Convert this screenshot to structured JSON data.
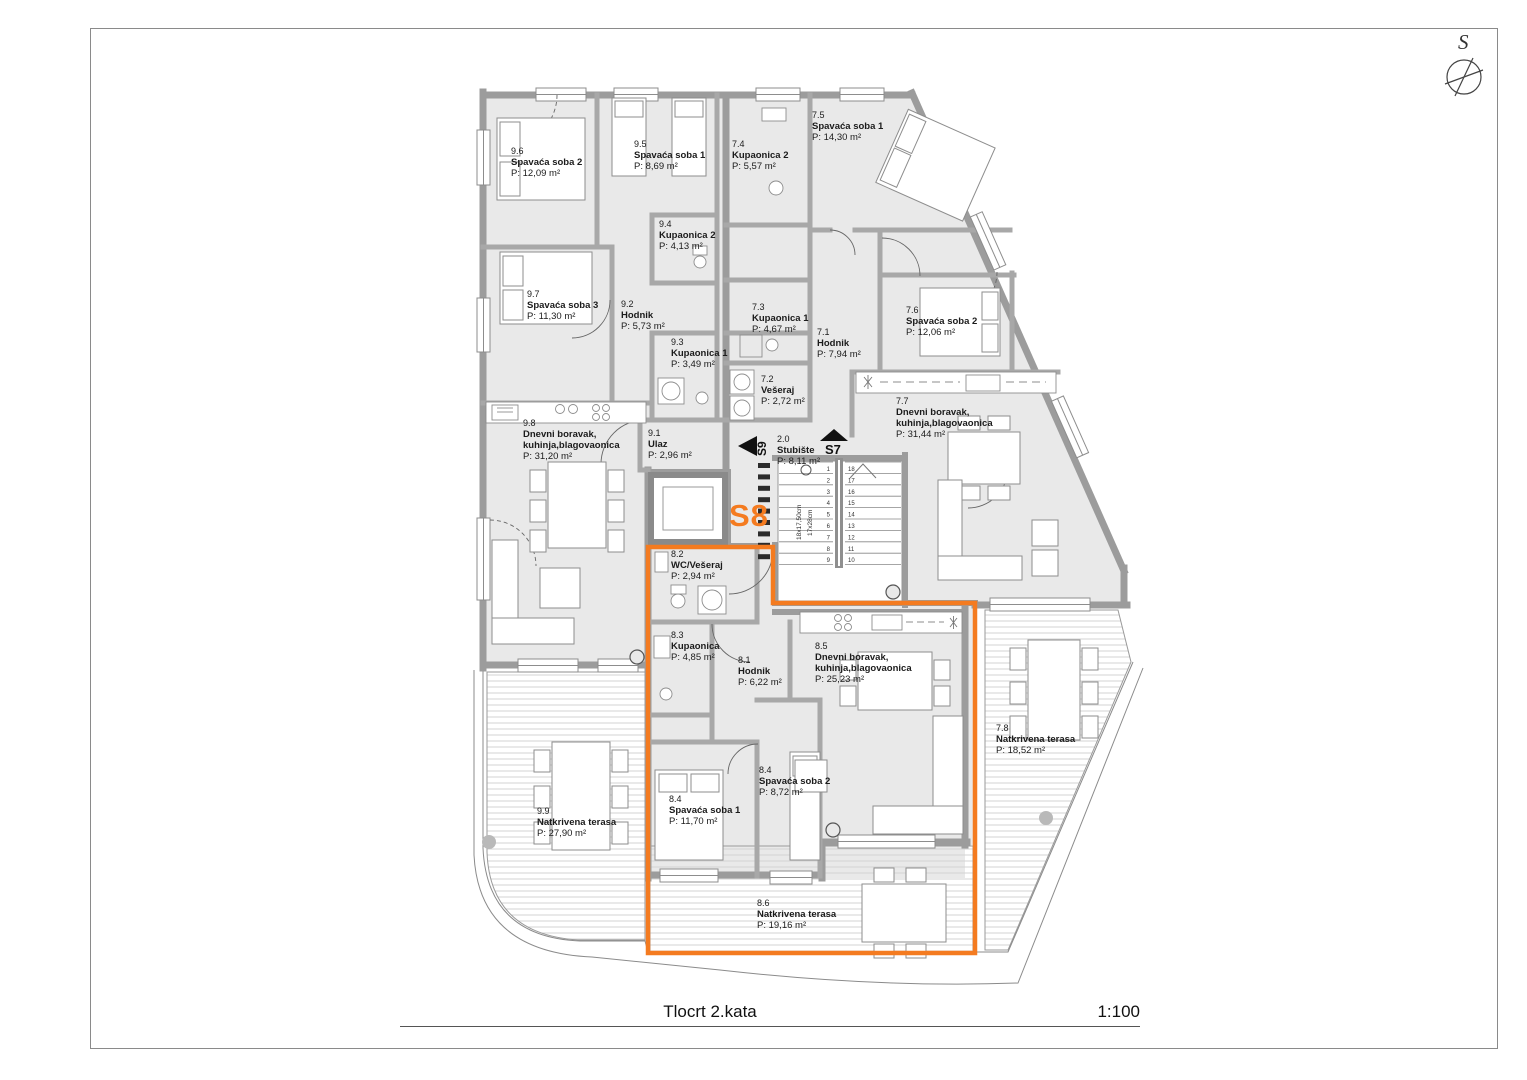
{
  "page": {
    "title": "Tlocrt 2.kata",
    "scale": "1:100",
    "north_label": "S"
  },
  "unit_highlight": {
    "label": "S8",
    "color": "#f47b20"
  },
  "arrows": {
    "s9": "S9",
    "s7": "S7"
  },
  "stairs": {
    "dim_risers": "18x17,50cm",
    "dim_treads": "17x28cm",
    "left_numbers": [
      1,
      2,
      3,
      4,
      5,
      6,
      7,
      8,
      9
    ],
    "right_numbers": [
      18,
      17,
      16,
      15,
      14,
      13,
      12,
      11,
      10
    ]
  },
  "rooms": [
    {
      "id": "9.6",
      "name": "Spavaća soba 2",
      "area": "P: 12,09 m²",
      "x": 511,
      "y": 146
    },
    {
      "id": "9.5",
      "name": "Spavaća soba 1",
      "area": "P: 8,69 m²",
      "x": 634,
      "y": 139
    },
    {
      "id": "9.4",
      "name": "Kupaonica 2",
      "area": "P: 4,13 m²",
      "x": 659,
      "y": 219
    },
    {
      "id": "9.7",
      "name": "Spavaća soba 3",
      "area": "P: 11,30 m²",
      "x": 527,
      "y": 289
    },
    {
      "id": "9.2",
      "name": "Hodnik",
      "area": "P: 5,73 m²",
      "x": 621,
      "y": 299
    },
    {
      "id": "9.3",
      "name": "Kupaonica 1",
      "area": "P: 3,49 m²",
      "x": 671,
      "y": 337
    },
    {
      "id": "9.8",
      "name": "Dnevni boravak,\nkuhinja,blagovaonica",
      "area": "P: 31,20 m²",
      "x": 523,
      "y": 418
    },
    {
      "id": "9.1",
      "name": "Ulaz",
      "area": "P: 2,96 m²",
      "x": 648,
      "y": 428
    },
    {
      "id": "9.9",
      "name": "Natkrivena terasa",
      "area": "P: 27,90 m²",
      "x": 537,
      "y": 806
    },
    {
      "id": "7.4",
      "name": "Kupaonica 2",
      "area": "P: 5,57 m²",
      "x": 732,
      "y": 139
    },
    {
      "id": "7.5",
      "name": "Spavaća soba 1",
      "area": "P: 14,30 m²",
      "x": 812,
      "y": 110
    },
    {
      "id": "7.3",
      "name": "Kupaonica 1",
      "area": "P: 4,67 m²",
      "x": 752,
      "y": 302
    },
    {
      "id": "7.1",
      "name": "Hodnik",
      "area": "P: 7,94 m²",
      "x": 817,
      "y": 327
    },
    {
      "id": "7.6",
      "name": "Spavaća soba 2",
      "area": "P: 12,06 m²",
      "x": 906,
      "y": 305
    },
    {
      "id": "7.2",
      "name": "Vešeraj",
      "area": "P: 2,72 m²",
      "x": 761,
      "y": 374
    },
    {
      "id": "7.7",
      "name": "Dnevni boravak,\nkuhinja,blagovaonica",
      "area": "P: 31,44 m²",
      "x": 896,
      "y": 396
    },
    {
      "id": "7.8",
      "name": "Natkrivena terasa",
      "area": "P: 18,52 m²",
      "x": 996,
      "y": 723
    },
    {
      "id": "2.0",
      "name": "Stubište",
      "area": "P: 8,11 m²",
      "x": 777,
      "y": 434
    },
    {
      "id": "8.2",
      "name": "WC/Vešeraj",
      "area": "P: 2,94 m²",
      "x": 671,
      "y": 549
    },
    {
      "id": "8.3",
      "name": "Kupaonica",
      "area": "P: 4,85 m²",
      "x": 671,
      "y": 630
    },
    {
      "id": "8.1",
      "name": "Hodnik",
      "area": "P: 6,22 m²",
      "x": 738,
      "y": 655
    },
    {
      "id": "8.5",
      "name": "Dnevni boravak,\nkuhinja,blagovaonica",
      "area": "P: 25,23 m²",
      "x": 815,
      "y": 641
    },
    {
      "id": "8.4",
      "name": "Spavaća soba 1",
      "area": "P: 11,70 m²",
      "x": 669,
      "y": 794
    },
    {
      "id": "8.4",
      "name": "Spavaća soba 2",
      "area": "P: 8,72 m²",
      "x": 759,
      "y": 765
    },
    {
      "id": "8.6",
      "name": "Natkrivena terasa",
      "area": "P: 19,16 m²",
      "x": 757,
      "y": 898
    }
  ]
}
